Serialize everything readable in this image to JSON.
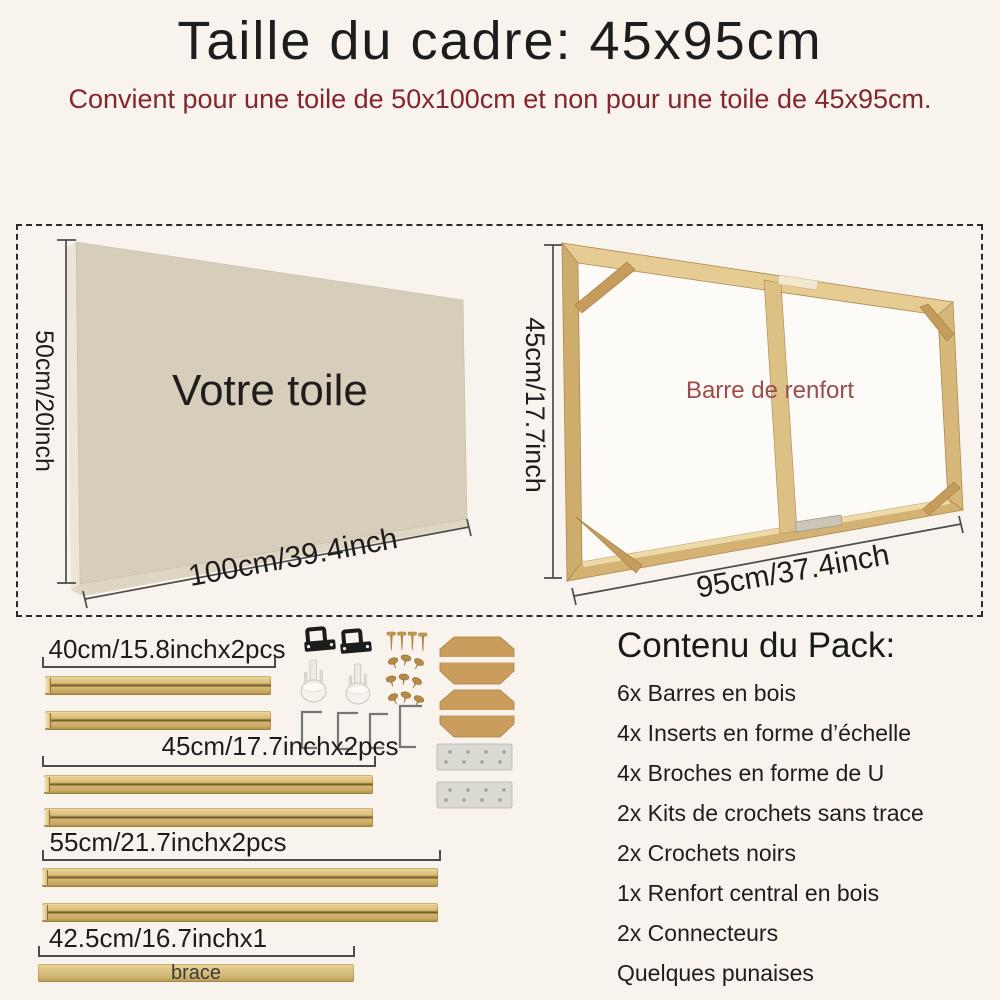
{
  "header": {
    "title": "Taille du cadre: 45x95cm",
    "subtitle": "Convient pour une toile de 50x100cm et non pour une toile de 45x95cm."
  },
  "diagram": {
    "canvas": {
      "label": "Votre toile",
      "height_label": "50cm/20inch",
      "width_label": "100cm/39.4inch"
    },
    "frame": {
      "height_label": "45cm/17.7inch",
      "width_label": "95cm/37.4inch",
      "annotation": "Barre de renfort"
    }
  },
  "parts": {
    "bars": [
      {
        "label": "40cm/15.8inchx2pcs",
        "pieces": 2
      },
      {
        "label": "45cm/17.7inchx2pcs",
        "pieces": 2
      },
      {
        "label": "55cm/21.7inchx2pcs",
        "pieces": 2
      },
      {
        "label": "42.5cm/16.7inchx1",
        "pieces": 1,
        "bar_text": "brace"
      }
    ],
    "hardware": [
      "black-hook",
      "screw",
      "plastic-anchor",
      "tack",
      "u-pin",
      "corner-wedge",
      "connector-plate"
    ]
  },
  "pack": {
    "heading": "Contenu du Pack:",
    "items": [
      "6x Barres en bois",
      "4x Inserts en forme d’échelle",
      "4x Broches en forme de U",
      "2x Kits de crochets sans trace",
      "2x Crochets noirs",
      "1x Renfort central en bois",
      "2x Connecteurs",
      "Quelques punaises"
    ]
  },
  "colors": {
    "background": "#f8f3ec",
    "title": "#1d1d1d",
    "subtitle_red": "#84262e",
    "annotation_red": "#9e4b4b",
    "canvas_beige": "#d7cdbb",
    "wood": "#dcbc7d",
    "measure_line": "#4c4c4c"
  }
}
